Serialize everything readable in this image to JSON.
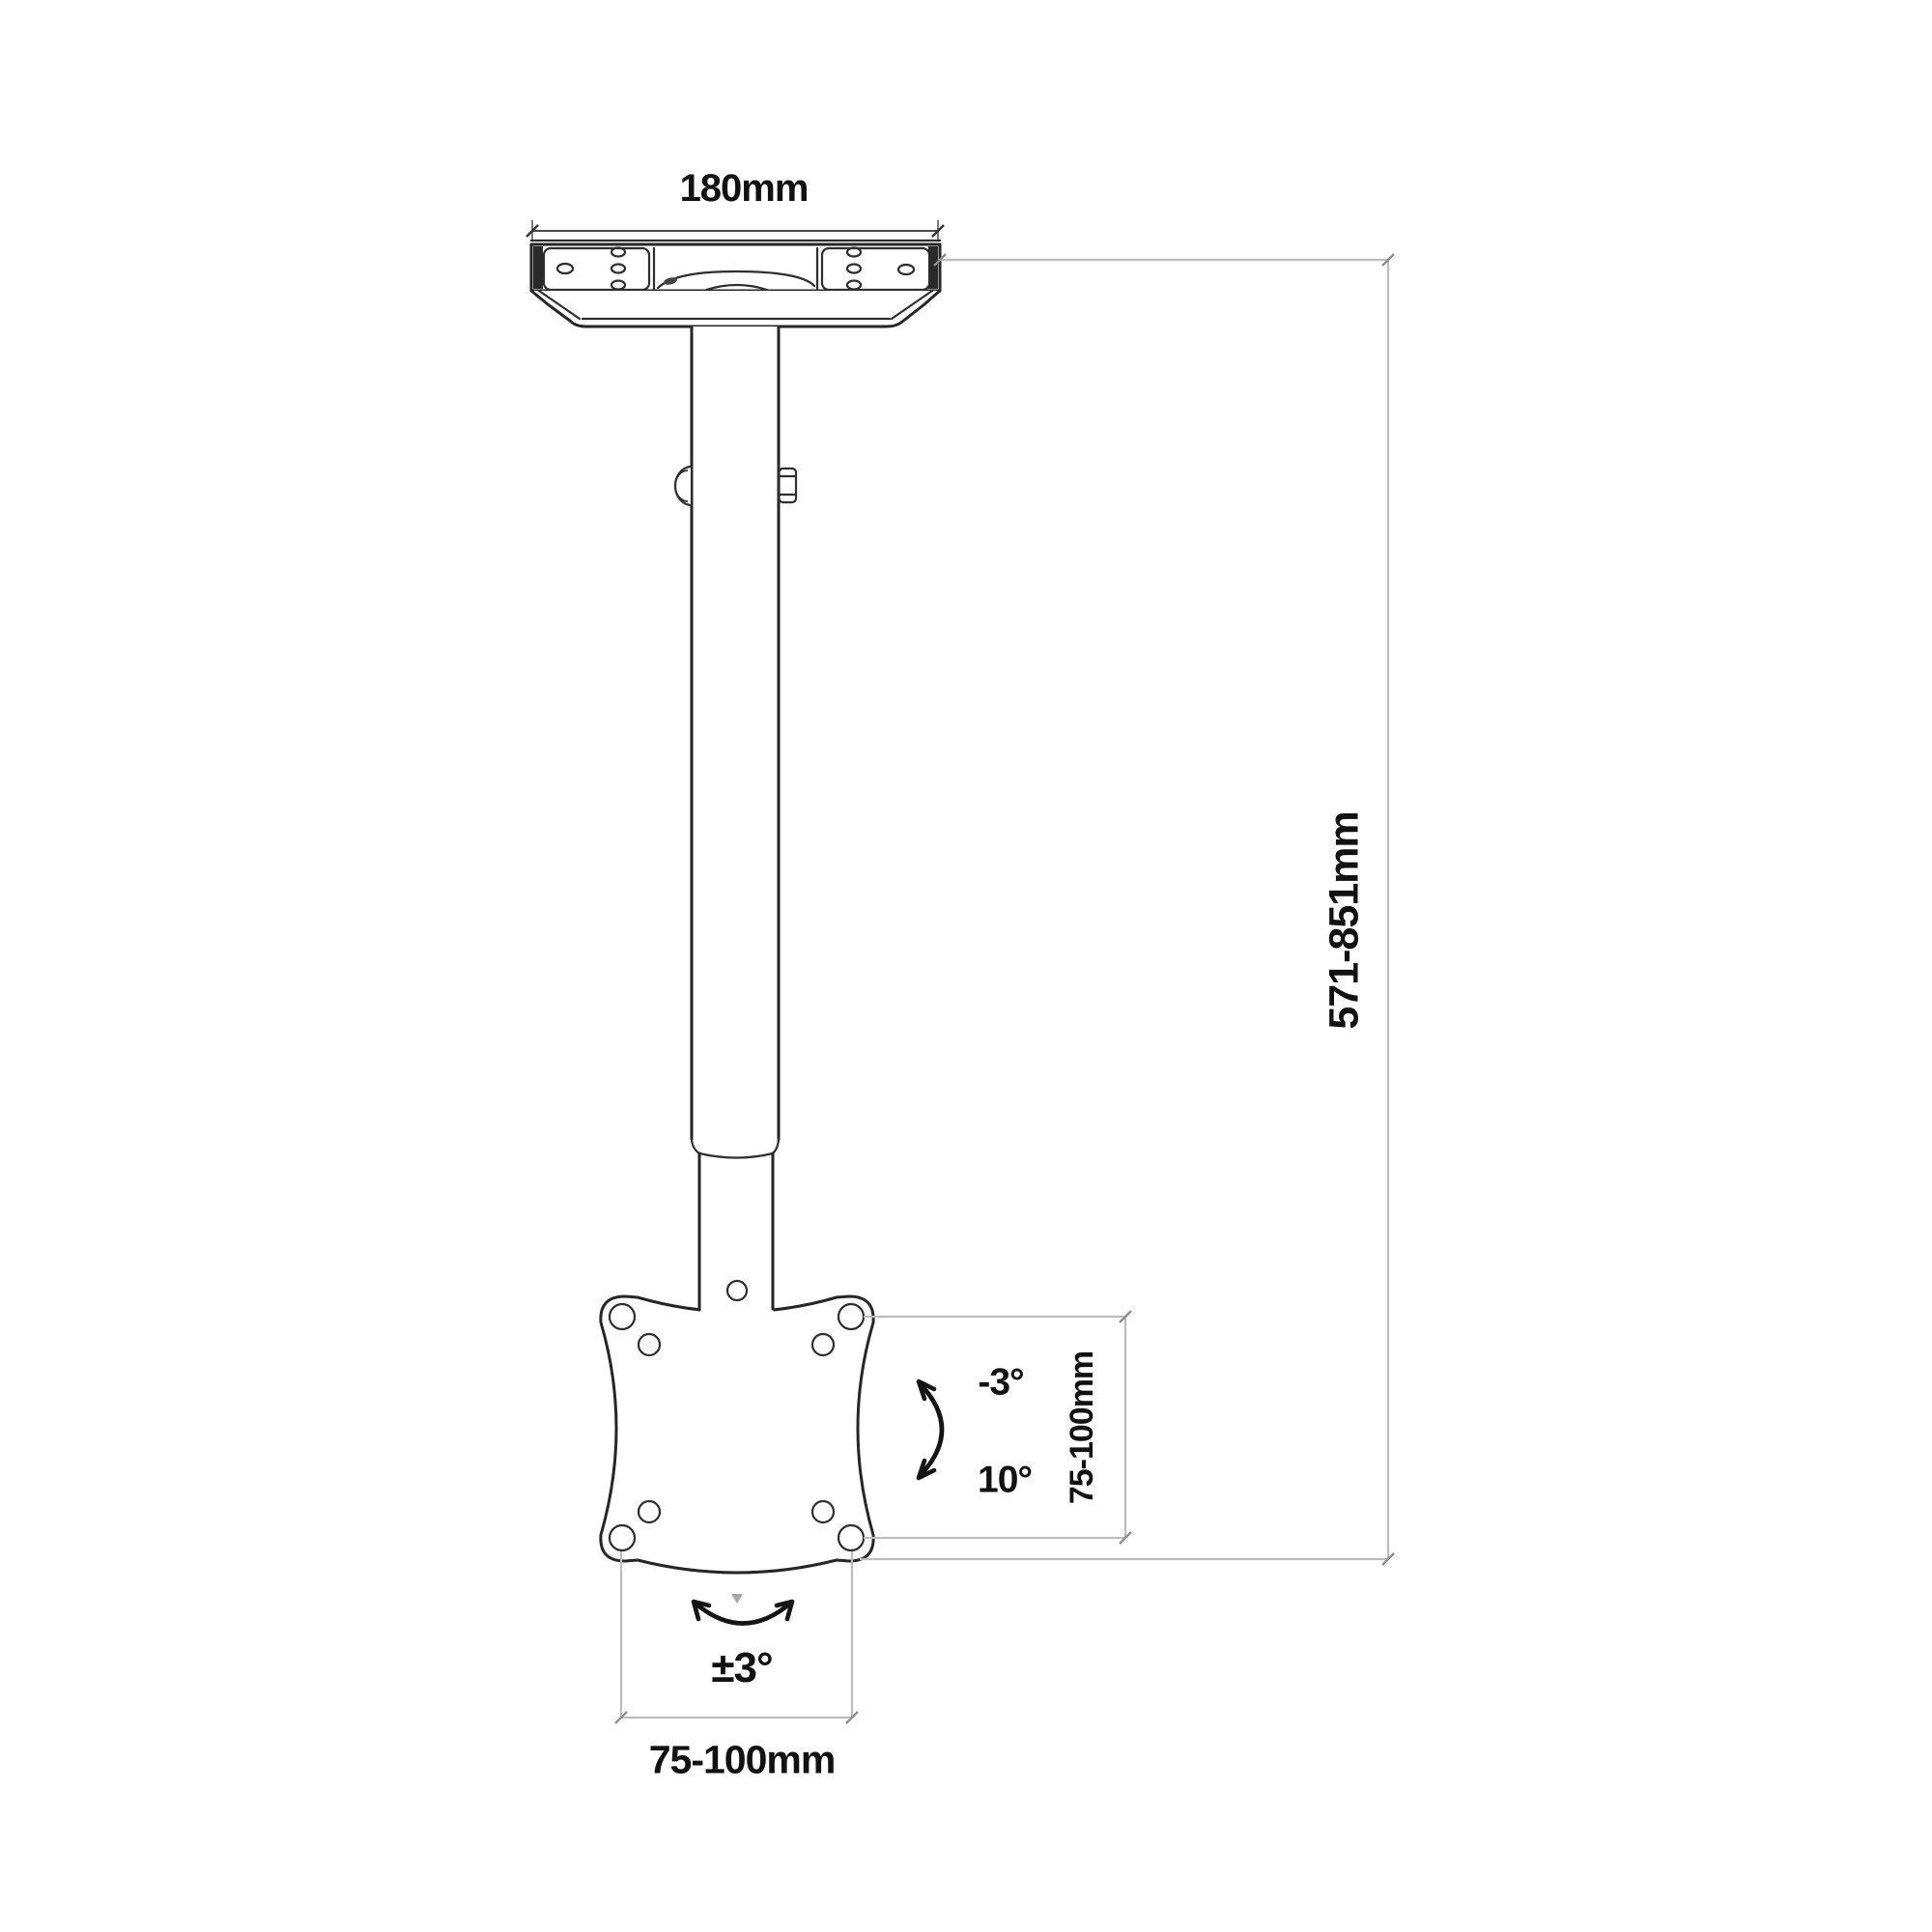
{
  "labels": {
    "plate_width": "180mm",
    "height_range": "571-851mm",
    "vesa_vertical": "75-100mm",
    "vesa_horizontal": "75-100mm",
    "tilt_min": "-3°",
    "tilt_max": "10°",
    "swivel_range": "±3°"
  },
  "colors": {
    "background": "#ffffff",
    "drawing_line": "#262626",
    "dimension_line": "#bdbdbd",
    "dimension_dark": "#4a4a4a",
    "arrow": "#141414",
    "text": "#111111"
  }
}
